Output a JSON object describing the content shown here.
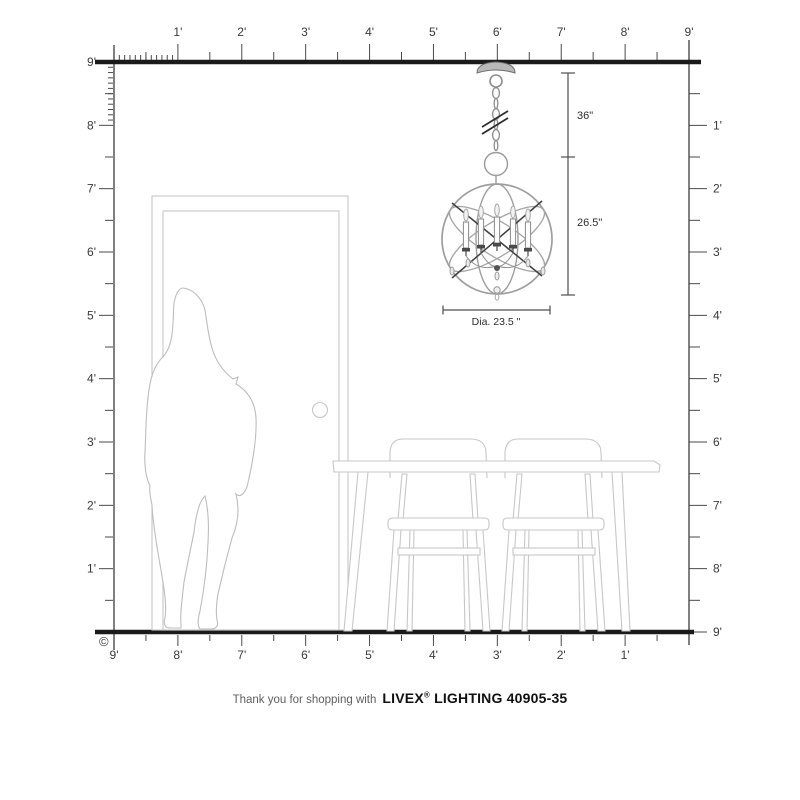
{
  "page": {
    "background": "#ffffff"
  },
  "colors": {
    "ruler_line": "#4a4a4a",
    "ruler_label": "#3a3a3a",
    "thick_line": "#1a1a1a",
    "furniture_outline": "#c7c7c7",
    "silhouette_outline": "#bdbdbd",
    "fixture_gray": "#9e9e9e",
    "fixture_dark": "#3f3f3f",
    "dimension_line": "#4d4d4d"
  },
  "rulers": {
    "top": {
      "labels": [
        "1'",
        "2'",
        "3'",
        "4'",
        "5'",
        "6'",
        "7'",
        "8'",
        "9'"
      ]
    },
    "left": {
      "labels": [
        "9'",
        "8'",
        "7'",
        "6'",
        "5'",
        "4'",
        "3'",
        "2'",
        "1'"
      ]
    },
    "right": {
      "labels": [
        "1'",
        "2'",
        "3'",
        "4'",
        "5'",
        "6'",
        "7'",
        "8'",
        "9'"
      ]
    },
    "bottom": {
      "labels": [
        "9'",
        "8'",
        "7'",
        "6'",
        "5'",
        "4'",
        "3'",
        "2'",
        "1'"
      ]
    }
  },
  "dimensions": {
    "chain_length": "36\"",
    "fixture_height": "26.5\"",
    "diameter": "Dia. 23.5 \""
  },
  "copyright": "©",
  "footer": {
    "prefix": "Thank you for shopping with",
    "brand": "LIVEX",
    "registered": "®",
    "suffix": " LIGHTING 40905-35"
  }
}
